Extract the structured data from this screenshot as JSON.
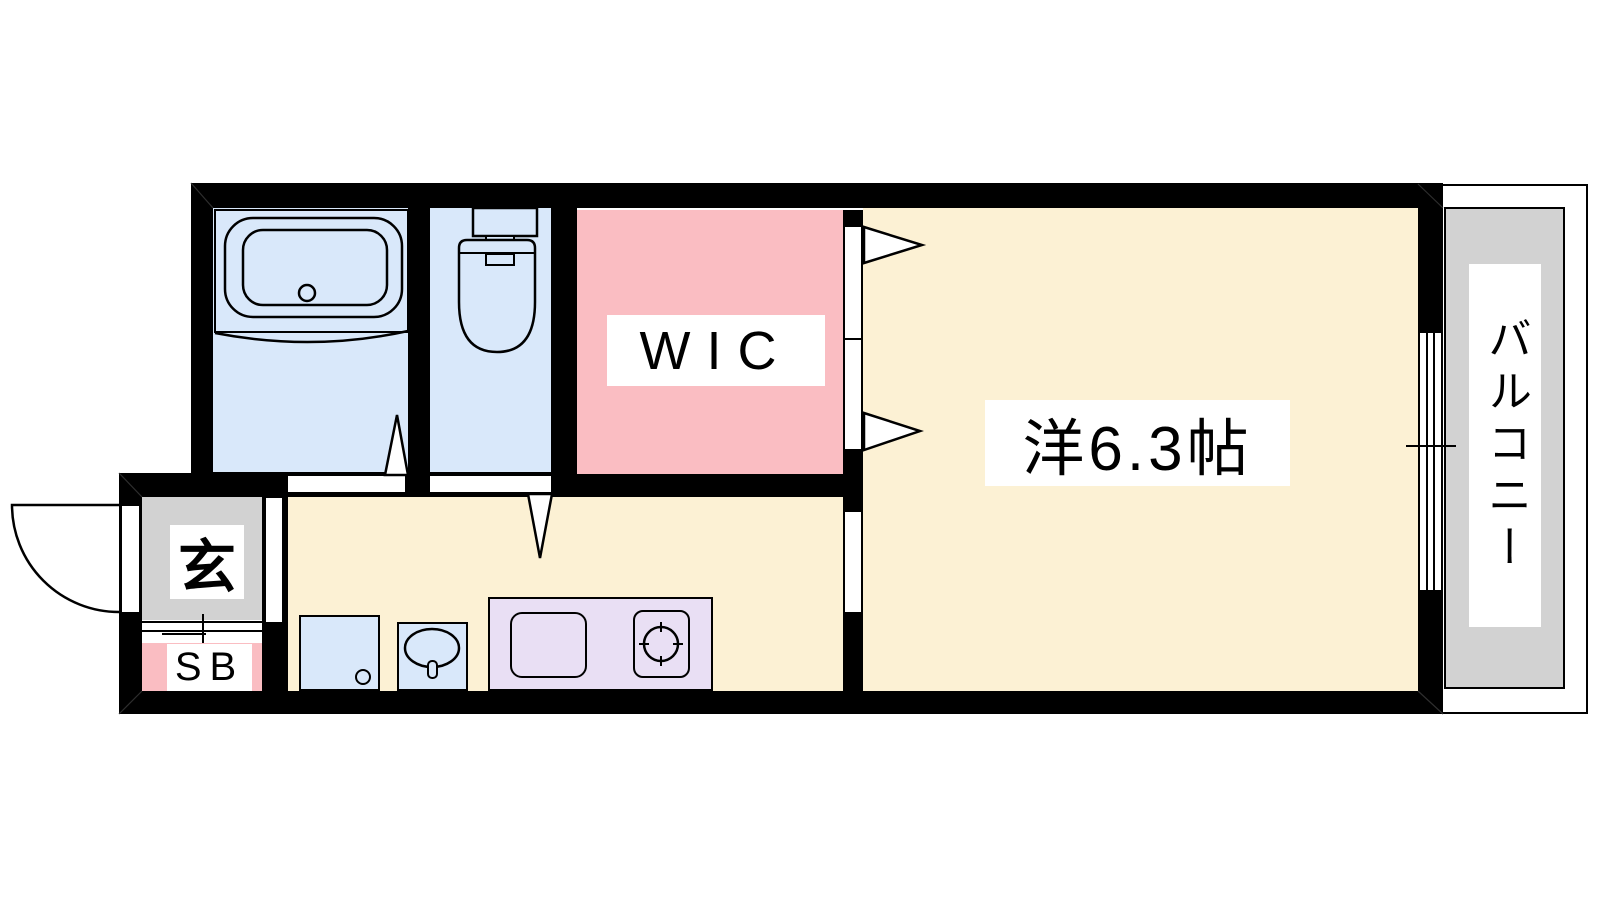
{
  "plan": {
    "title": "1K apartment floor plan",
    "labels": {
      "wic": "WIC",
      "main_room": "洋6.3帖",
      "balcony": "バルコニー",
      "entrance": "玄",
      "shoe_box": "SB"
    },
    "colors": {
      "wall": "#000000",
      "wet_area": "#D9E8FA",
      "closet": "#FABDC2",
      "living": "#FCF1D4",
      "entrance": "#D2D2D2",
      "balcony": "#D2D2D2",
      "kitchen_counter": "#E9DFF4",
      "label_bg": "#FFFFFF"
    },
    "fixtures": [
      "bathtub",
      "toilet",
      "washing-machine",
      "washbasin",
      "kitchen-sink",
      "stove-burner"
    ]
  }
}
